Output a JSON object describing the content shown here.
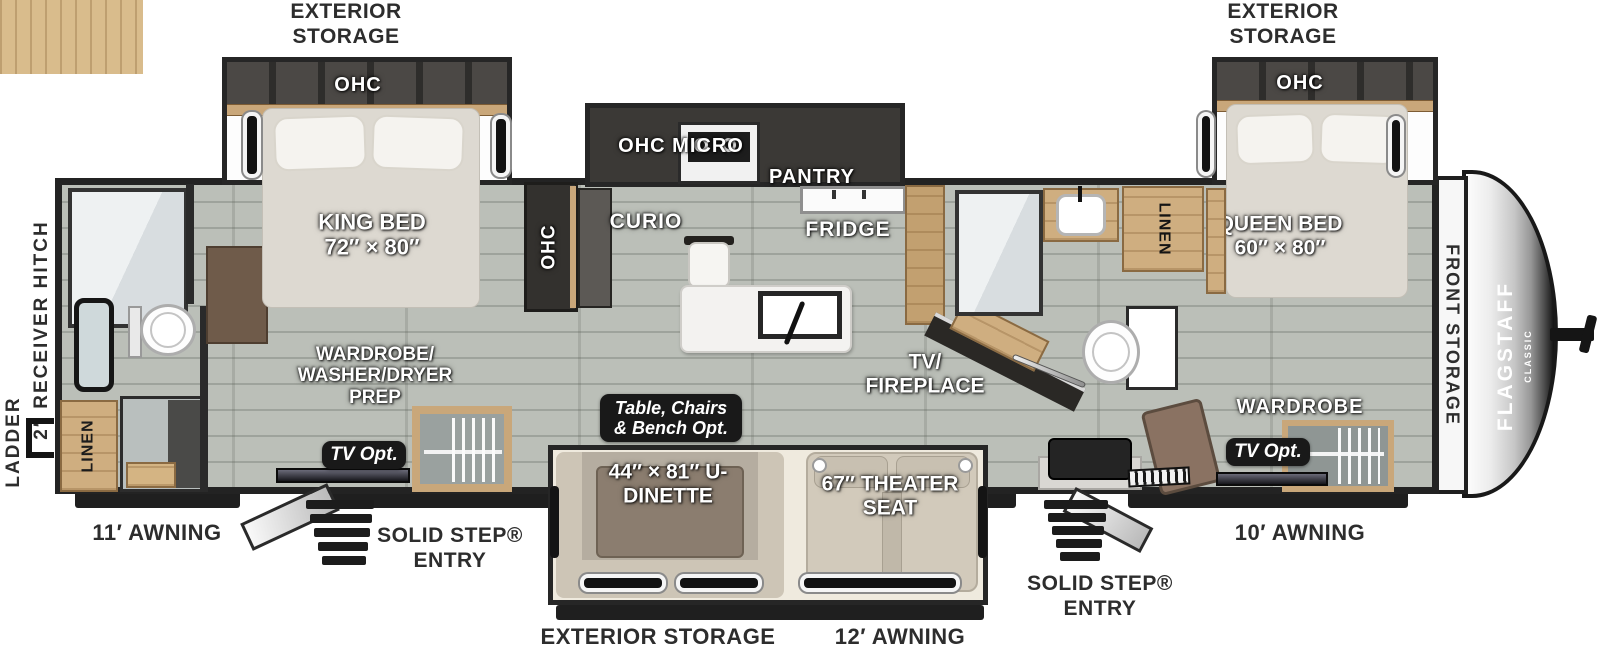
{
  "colors": {
    "floor": "#b7bbb4",
    "wall": "#232323",
    "wood": "#cfae80",
    "badge_bg": "#191919",
    "label_dark": "#2d2d2d"
  },
  "exterior": {
    "storage_top_left": "EXTERIOR STORAGE",
    "storage_top_right": "EXTERIOR STORAGE",
    "storage_bottom": "EXTERIOR STORAGE",
    "awning_rear": "11′ AWNING",
    "awning_center": "12′ AWNING",
    "awning_front": "10′ AWNING",
    "entry_rear": "SOLID STEP® ENTRY",
    "entry_front": "SOLID STEP® ENTRY",
    "ladder": "LADDER",
    "hitch": "2″ RECEIVER HITCH",
    "front_storage": "FRONT STORAGE",
    "brand": "FLAGSTAFF",
    "brand_sub": "CLASSIC"
  },
  "rear_bedroom": {
    "ohc": "OHC",
    "bed": "KING BED 72″ × 80″",
    "wardrobe_prep": "WARDROBE/ WASHER/DRYER PREP",
    "tv_opt": "TV Opt.",
    "linen": "LINEN",
    "ohc_cabinet": "OHC"
  },
  "kitchen": {
    "ohc_micro": "OHC MICRO",
    "pantry": "PANTRY",
    "fridge": "FRIDGE",
    "curio": "CURIO"
  },
  "living": {
    "dinette": "44″ × 81″ U-DINETTE",
    "dinette_option": "Table, Chairs & Bench Opt.",
    "theater_seat": "67″ THEATER SEAT",
    "tv_fireplace": "TV/ FIREPLACE"
  },
  "mid_bath": {
    "linen": "LINEN"
  },
  "front_bedroom": {
    "ohc": "OHC",
    "bed": "QUEEN BED 60″ × 80″",
    "wardrobe": "WARDROBE",
    "tv_opt": "TV Opt."
  }
}
